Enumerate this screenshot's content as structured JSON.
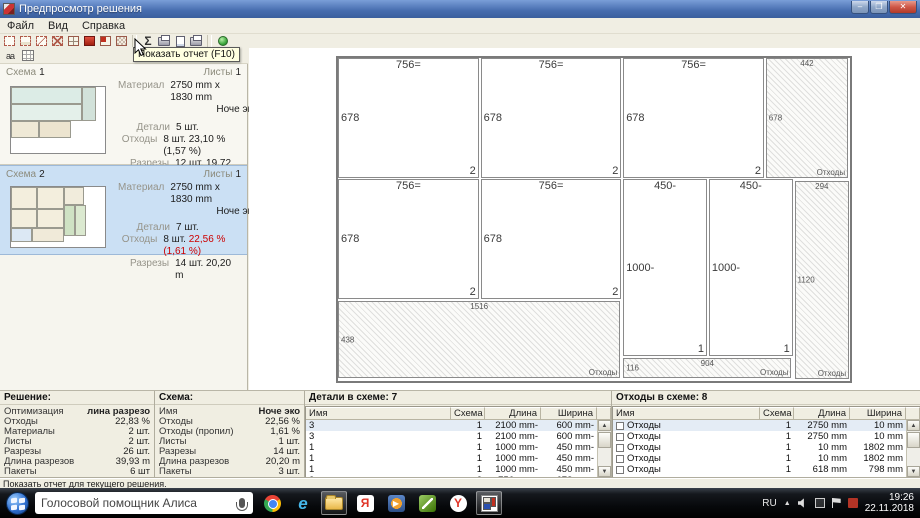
{
  "window": {
    "title": "Предпросмотр решения",
    "controls": {
      "minimize": "–",
      "maximize": "❐",
      "close": "✕"
    }
  },
  "menu": {
    "items": [
      "Файл",
      "Вид",
      "Справка"
    ]
  },
  "toolbar": {
    "tooltip": "Показать отчет (F10)",
    "buttons": [
      {
        "name": "tool-sheet-outline-icon",
        "kind": "frame"
      },
      {
        "name": "tool-piece-outline-icon",
        "kind": "frame2"
      },
      {
        "name": "tool-diagonal-icon",
        "kind": "frame3"
      },
      {
        "name": "tool-cross-icon",
        "kind": "frame4"
      },
      {
        "name": "tool-grid-icon",
        "kind": "grid"
      },
      {
        "name": "tool-fill-icon",
        "kind": "redsq"
      },
      {
        "name": "tool-grid-red-icon",
        "kind": "gridred"
      },
      {
        "name": "tool-grid-pattern-icon",
        "kind": "gridpat"
      },
      {
        "kind": "sep"
      },
      {
        "name": "show-report-icon",
        "kind": "sigma",
        "glyph": "Σ"
      },
      {
        "name": "print-icon",
        "kind": "printer"
      },
      {
        "name": "print-preview-icon",
        "kind": "page"
      },
      {
        "name": "print-setup-icon",
        "kind": "printer"
      },
      {
        "kind": "sep"
      },
      {
        "name": "run-icon",
        "kind": "greendot"
      }
    ],
    "row2": [
      {
        "name": "text-size-icon",
        "kind": "aa",
        "glyph": "aa"
      },
      {
        "name": "table-view-icon",
        "kind": "grid2"
      }
    ]
  },
  "sidebar": {
    "schemes": [
      {
        "label": "Схема",
        "number": "1",
        "sheets_label": "Листы",
        "sheets": "1",
        "material_label": "Материал",
        "material": "2750 mm x 1830 mm",
        "material_name": "Ноче эко",
        "details_label": "Детали",
        "details": "5 шт.",
        "waste_label": "Отходы",
        "waste_count": "8 шт.",
        "waste_pct": "23,10 % (1,57 %)",
        "cuts_label": "Разрезы",
        "cuts": "12 шт. 19,72 m"
      },
      {
        "label": "Схема",
        "number": "2",
        "sheets_label": "Листы",
        "sheets": "1",
        "material_label": "Материал",
        "material": "2750 mm x 1830 mm",
        "material_name": "Ноче эко",
        "details_label": "Детали",
        "details": "7 шт.",
        "waste_label": "Отходы",
        "waste_count": "8 шт.",
        "waste_pct": "22,56 % (1,61 %)",
        "cuts_label": "Разрезы",
        "cuts": "14 шт. 20,20 m"
      }
    ]
  },
  "diagram": {
    "sheet_mm": [
      2750,
      1830
    ],
    "rects": [
      {
        "x": 0,
        "y": 0,
        "w": 756,
        "h": 678,
        "top": "756=",
        "left": "678",
        "corner": "2",
        "waste": false
      },
      {
        "x": 766,
        "y": 0,
        "w": 756,
        "h": 678,
        "top": "756=",
        "left": "678",
        "corner": "2",
        "waste": false
      },
      {
        "x": 1532,
        "y": 0,
        "w": 756,
        "h": 678,
        "top": "756=",
        "left": "678",
        "corner": "2",
        "waste": false
      },
      {
        "x": 2298,
        "y": 0,
        "w": 442,
        "h": 678,
        "top": "442",
        "left": "678",
        "corner": "Отходы",
        "waste": true
      },
      {
        "x": 0,
        "y": 688,
        "w": 756,
        "h": 678,
        "top": "756=",
        "left": "678",
        "corner": "2",
        "waste": false
      },
      {
        "x": 766,
        "y": 688,
        "w": 756,
        "h": 678,
        "top": "756=",
        "left": "678",
        "corner": "2",
        "waste": false
      },
      {
        "x": 1532,
        "y": 688,
        "w": 450,
        "h": 1000,
        "top": "450-",
        "left": "1000-",
        "corner": "1",
        "waste": false
      },
      {
        "x": 1992,
        "y": 688,
        "w": 450,
        "h": 1000,
        "top": "450-",
        "left": "1000-",
        "corner": "1",
        "waste": false
      },
      {
        "x": 0,
        "y": 1376,
        "w": 1516,
        "h": 438,
        "top": "1516",
        "left": "438",
        "corner": "Отходы",
        "waste": true
      },
      {
        "x": 1532,
        "y": 1698,
        "w": 904,
        "h": 116,
        "top": "904",
        "left": "116",
        "corner": "Отходы",
        "waste": true
      },
      {
        "x": 2452,
        "y": 694,
        "w": 294,
        "h": 1124,
        "top": "294",
        "left": "1120",
        "corner": "Отходы",
        "waste": true
      }
    ]
  },
  "solution_panel": {
    "title": "Решение:",
    "rows": [
      [
        "Оптимизация",
        "лина разрезо"
      ],
      [
        "Отходы",
        "22,83 %"
      ],
      [
        "Материалы",
        "2 шт."
      ],
      [
        "Листы",
        "2 шт."
      ],
      [
        "Разрезы",
        "26 шт."
      ],
      [
        "Длина разрезов",
        "39,93 m"
      ],
      [
        "Пакеты",
        "6 шт"
      ]
    ]
  },
  "scheme_panel": {
    "title": "Схема:",
    "rows": [
      [
        "Имя",
        "Ноче эко"
      ],
      [
        "Отходы",
        "22,56 %"
      ],
      [
        "Отходы (пропил)",
        "1,61 %"
      ],
      [
        "Листы",
        "1 шт."
      ],
      [
        "Разрезы",
        "14 шт."
      ],
      [
        "Длина разрезов",
        "20,20 m"
      ],
      [
        "Пакеты",
        "3 шт."
      ]
    ]
  },
  "details_panel": {
    "title": "Детали в схеме: 7",
    "columns": [
      "Имя",
      "Схема",
      "Длина",
      "Ширина"
    ],
    "rows": [
      [
        "3",
        "1",
        "2100 mm-",
        "600 mm-"
      ],
      [
        "3",
        "1",
        "2100 mm-",
        "600 mm-"
      ],
      [
        "1",
        "1",
        "1000 mm-",
        "450 mm-"
      ],
      [
        "1",
        "1",
        "1000 mm-",
        "450 mm-"
      ],
      [
        "1",
        "1",
        "1000 mm-",
        "450 mm-"
      ],
      [
        "2",
        "2",
        "756 mm=",
        "678 mm-"
      ]
    ]
  },
  "waste_panel": {
    "title": "Отходы в схеме: 8",
    "columns": [
      "Имя",
      "Схема",
      "Длина",
      "Ширина"
    ],
    "rows": [
      [
        "Отходы",
        "1",
        "2750 mm",
        "10 mm"
      ],
      [
        "Отходы",
        "1",
        "2750 mm",
        "10 mm"
      ],
      [
        "Отходы",
        "1",
        "10 mm",
        "1802 mm"
      ],
      [
        "Отходы",
        "1",
        "10 mm",
        "1802 mm"
      ],
      [
        "Отходы",
        "1",
        "618 mm",
        "798 mm"
      ]
    ]
  },
  "statusbar": {
    "text": "Показать отчет для текущего решения."
  },
  "taskbar": {
    "search": "Голосовой помощник Алиса",
    "icons": [
      {
        "name": "taskbar-chrome-icon",
        "kind": "chrome",
        "active": false
      },
      {
        "name": "taskbar-ie-icon",
        "kind": "ie",
        "glyph": "e",
        "active": false
      },
      {
        "name": "taskbar-explorer-icon",
        "kind": "folder",
        "active": true
      },
      {
        "name": "taskbar-yandex-browser-icon",
        "kind": "ybr",
        "glyph": "Я",
        "active": false
      },
      {
        "name": "taskbar-media-player-icon",
        "kind": "player",
        "active": false
      },
      {
        "name": "taskbar-graphics-app-icon",
        "kind": "green",
        "active": false
      },
      {
        "name": "taskbar-yandex-icon",
        "kind": "yandex",
        "glyph": "Y",
        "active": false
      },
      {
        "name": "taskbar-cutting-app-icon",
        "kind": "cutapp",
        "active": true
      }
    ],
    "tray": {
      "lang": "RU",
      "expand": "▲",
      "time": "19:26",
      "date": "22.11.2018"
    }
  },
  "icons": {
    "scroll_up": "▲",
    "scroll_down": "▼"
  },
  "colors": {
    "accent_selected": "#cbe0f4",
    "waste_red": "#cc0000",
    "titlebar": "#466cae"
  }
}
